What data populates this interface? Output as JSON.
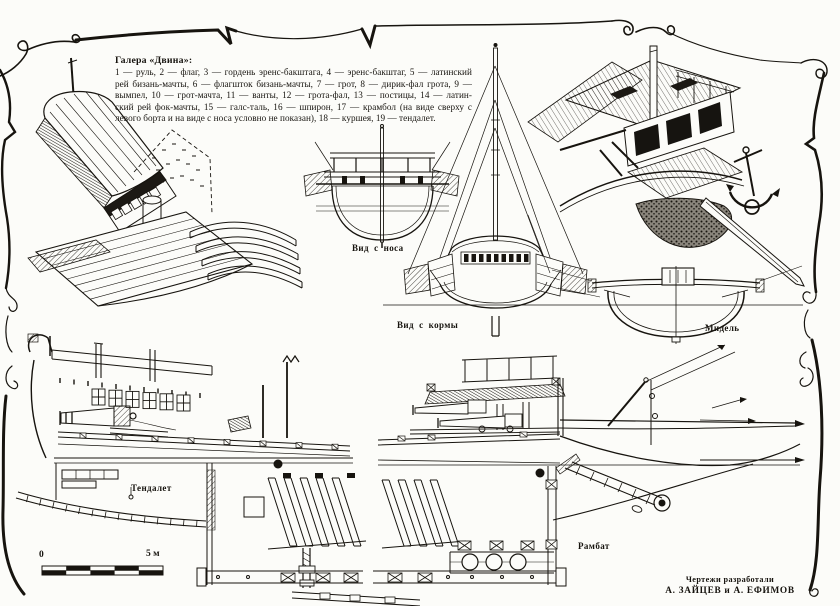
{
  "page": {
    "background": "#fcfcf9",
    "ink": "#17140f"
  },
  "legend": {
    "title": "Галера «Двина»:",
    "lines": [
      "1 — руль, 2 — флаг, 3 — гордень эренс-бакштага, 4 — эренс-бакштаг, 5 — латинский",
      "рей бизань-мачты, 6 — флагшток бизань-мачты, 7 — грот, 8 — дирик-фал грота, 9 —",
      "вымпел, 10 — грот-мачта, 11 — ванты, 12 — грота-фал, 13 — постицы, 14 — латин-",
      "ский рей фок-мачты, 15 — галс-таль, 16 — шпирон, 17 — крамбол (на виде сверху с",
      "левого борта и на виде с носа условно не показан), 18 — куршея, 19 — тендалет."
    ]
  },
  "labels": {
    "bow_view": "Вид с носа",
    "stern_view": "Вид с кормы",
    "midship": "Мидель",
    "tendalet": "Тендалет",
    "rambat": "Рамбат"
  },
  "scale_bar": {
    "start": "0",
    "end": "5 м"
  },
  "credits": {
    "line1": "Чертежи разработали",
    "line2": "А. ЗАЙЦЕВ и А. ЕФИМОВ"
  }
}
